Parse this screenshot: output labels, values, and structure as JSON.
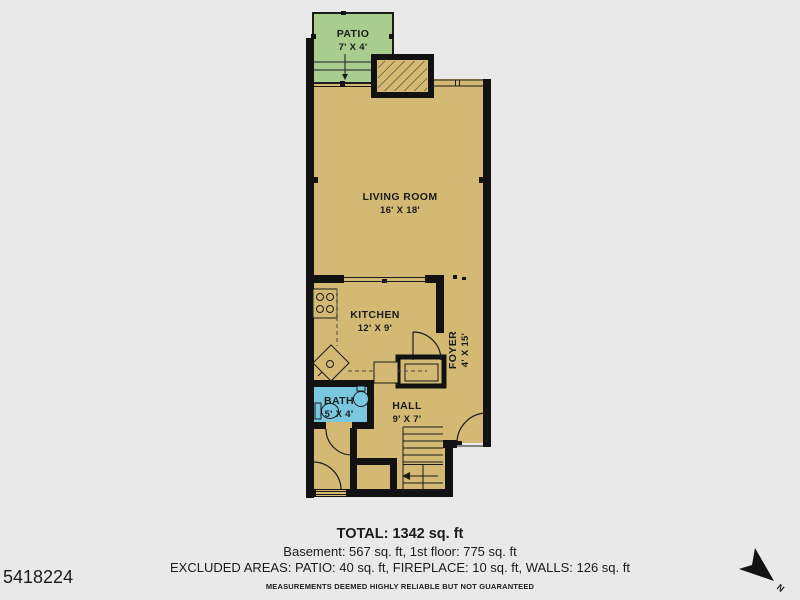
{
  "listing_id": "5418224",
  "plan": {
    "rooms": {
      "patio": {
        "name": "PATIO",
        "dims": "7' X 4'"
      },
      "living_room": {
        "name": "LIVING ROOM",
        "dims": "16' X 18'"
      },
      "kitchen": {
        "name": "KITCHEN",
        "dims": "12' X 9'"
      },
      "foyer": {
        "name": "FOYER",
        "dims": "4' X 15'"
      },
      "bath": {
        "name": "BATH",
        "dims": "5' X 4'"
      },
      "hall": {
        "name": "HALL",
        "dims": "9' X 7'"
      }
    }
  },
  "summary": {
    "total": "TOTAL: 1342 sq. ft",
    "floors": "Basement: 567 sq. ft, 1st floor: 775 sq. ft",
    "excluded": "EXCLUDED AREAS: PATIO: 40 sq. ft, FIREPLACE: 10 sq. ft, WALLS: 126 sq. ft",
    "disclaimer": "MEASUREMENTS DEEMED HIGHLY RELIABLE BUT NOT GUARANTEED"
  },
  "compass": {
    "label": "N"
  },
  "colors": {
    "floor": "#d3b973",
    "patio": "#a8cd8f",
    "bath": "#79c8e0",
    "wall": "#121212",
    "background": "#e9e9e9"
  }
}
